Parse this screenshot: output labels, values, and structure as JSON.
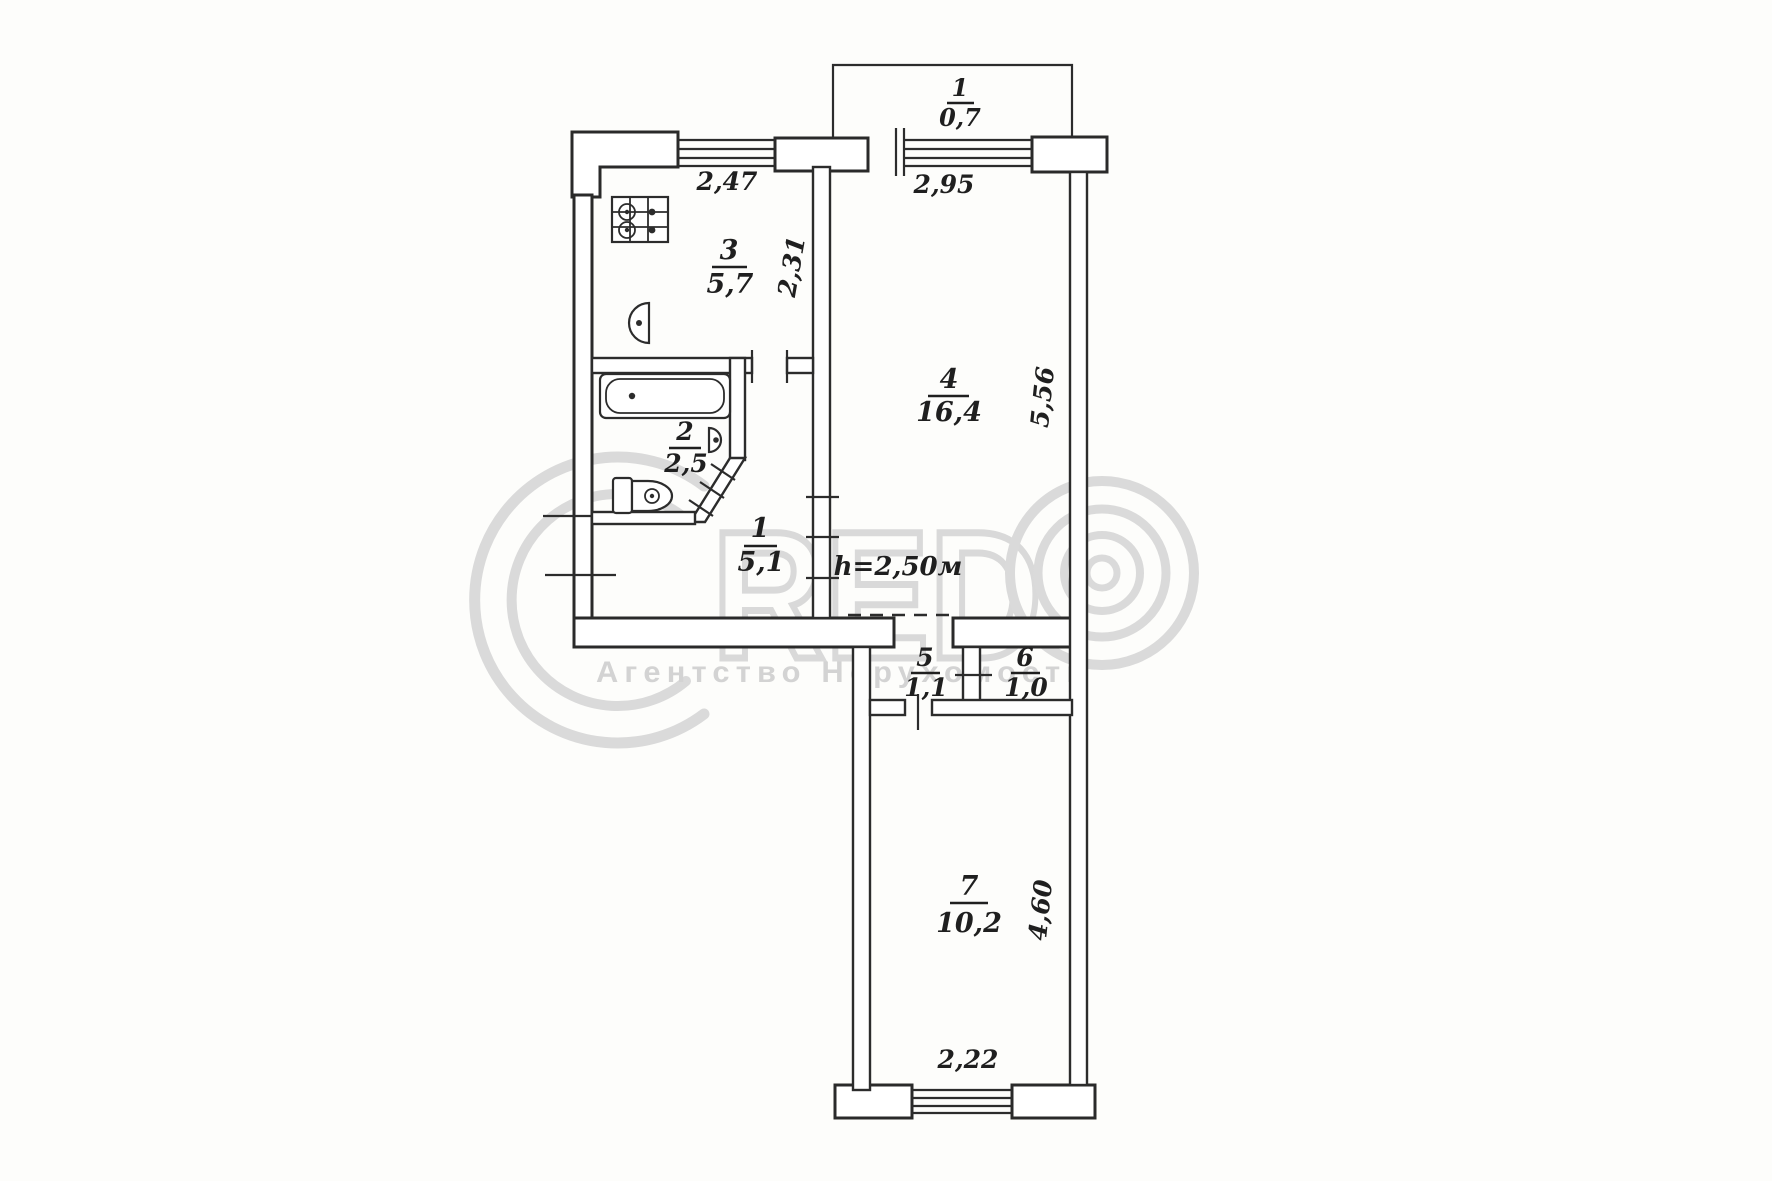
{
  "plan": {
    "rooms": [
      {
        "num": "1",
        "area": "0,7",
        "kind": "balcony"
      },
      {
        "num": "3",
        "area": "5,7",
        "kind": "kitchen"
      },
      {
        "num": "2",
        "area": "2,5",
        "kind": "bathroom"
      },
      {
        "num": "1",
        "area": "5,1",
        "kind": "hallway"
      },
      {
        "num": "4",
        "area": "16,4",
        "kind": "living-room"
      },
      {
        "num": "5",
        "area": "1,1",
        "kind": "vestibule"
      },
      {
        "num": "6",
        "area": "1,0",
        "kind": "closet"
      },
      {
        "num": "7",
        "area": "10,2",
        "kind": "room"
      }
    ],
    "dimensions": {
      "kitchen_width": "2,47",
      "room4_width": "2,95",
      "kitchen_depth": "2,31",
      "room4_depth": "5,56",
      "ceiling_height": "h=2,50м",
      "room7_depth": "4,60",
      "room7_width": "2,22"
    }
  },
  "watermark": {
    "letters": "RED",
    "subtitle": "Агентство Нерухомості"
  }
}
